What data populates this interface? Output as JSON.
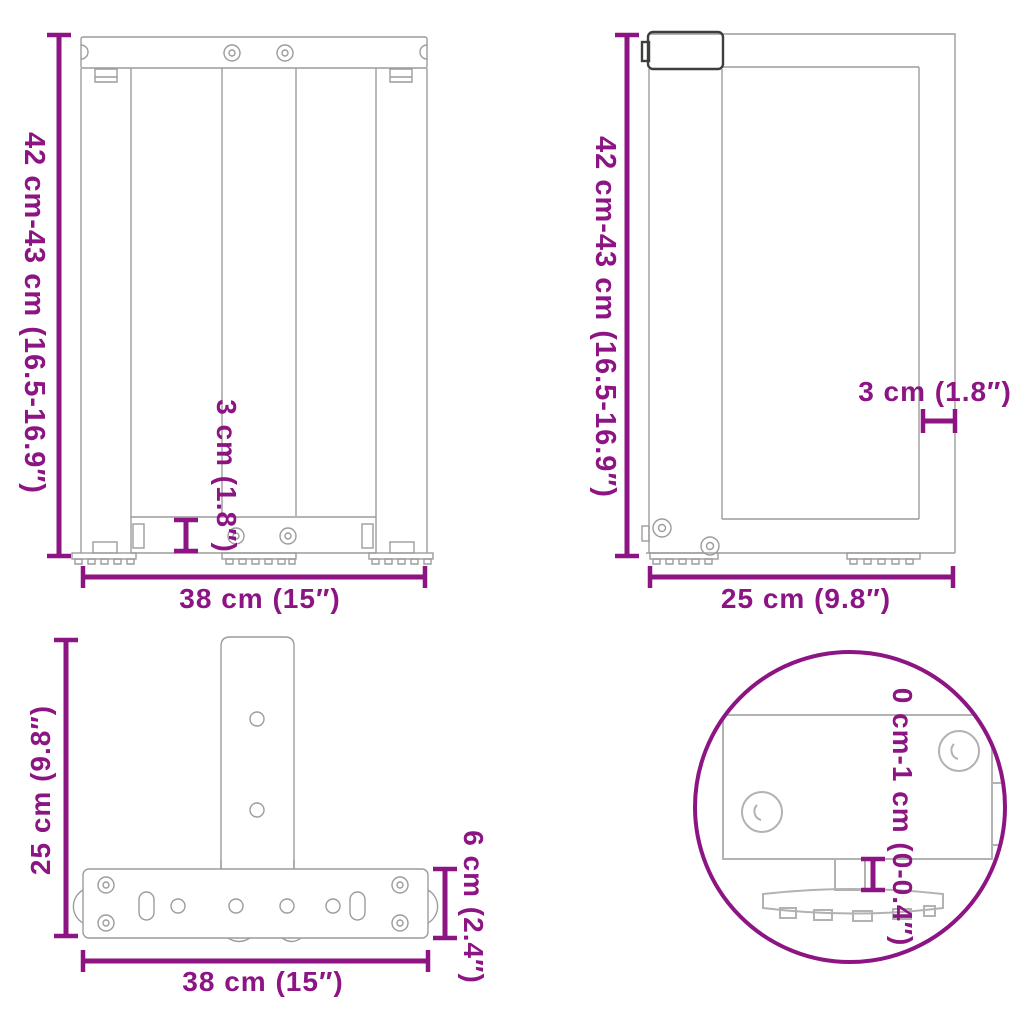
{
  "page": {
    "background": "#ffffff",
    "description_labels_only": "technical dimension diagram of T-shaped table legs, four views"
  },
  "colors": {
    "dimension_purple": "#8c1483",
    "line_gray": "#9c9c9c",
    "detail_gray": "#b2b2b2",
    "dark_outline": "#3e3e3e"
  },
  "figures": {
    "front_view": {
      "height_label": "42 cm-43 cm (16.5-16.9″)",
      "crossbar_label": "3 cm (1.8″)",
      "width_label": "38 cm (15″)"
    },
    "side_view": {
      "height_label": "42 cm-43 cm (16.5-16.9″)",
      "post_label": "3 cm (1.8″)",
      "depth_label": "25 cm (9.8″)"
    },
    "top_view": {
      "depth_label": "25 cm (9.8″)",
      "width_label": "38 cm (15″)",
      "plate_height_label": "6 cm (2.4″)"
    },
    "foot_detail": {
      "adjustment_label": "0 cm-1 cm (0-0.4″)"
    }
  }
}
